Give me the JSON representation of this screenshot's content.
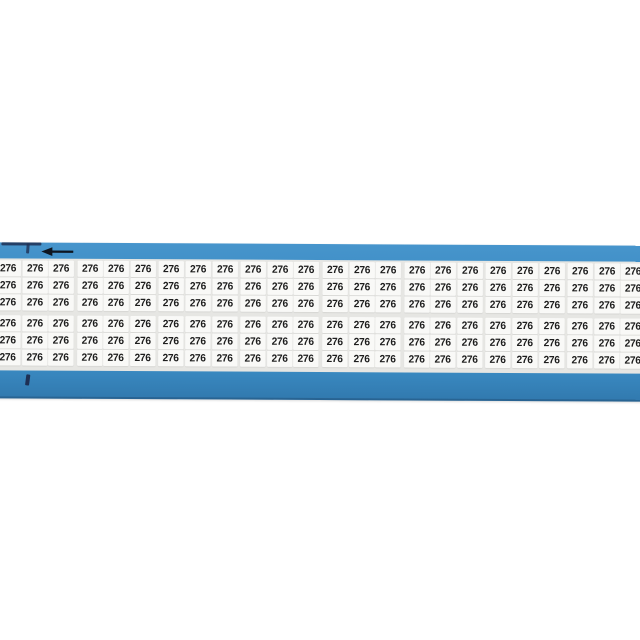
{
  "page": {
    "background_color": "#ffffff",
    "description": "wire-marker-card product photo"
  },
  "card": {
    "marker_text": "276",
    "grid": {
      "rows": 6,
      "columns": 24,
      "rows_per_group": 3,
      "columns_per_group": 3
    },
    "colors": {
      "card_color": "#3a8ac2",
      "card_color_light": "#4795cc",
      "card_color_dark": "#3179ae",
      "edge_mark_color": "#1e3054",
      "grid_bg_color": "#e6e6e3",
      "label_bg_color": "#f9f9f7",
      "label_text_color": "#1d1d1d",
      "arrow_color": "#0e1620"
    },
    "icons": {
      "arrow_icon": "left-arrow"
    }
  }
}
